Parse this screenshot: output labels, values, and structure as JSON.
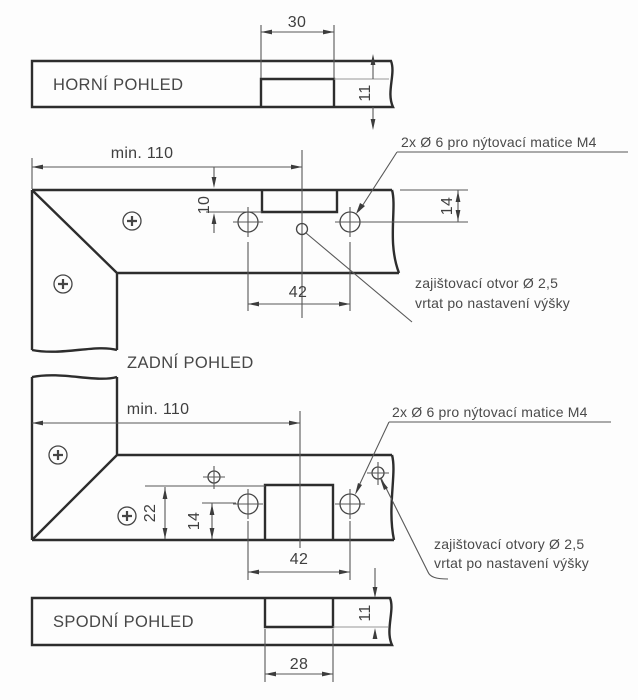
{
  "drawing_title": "Bracket mounting plate – orthographic views",
  "views": {
    "top": {
      "label": "HORNÍ POHLED",
      "dim_width": "30",
      "dim_depth": "11"
    },
    "rear": {
      "label": "ZADNÍ POHLED",
      "dim_min_width": "min. 110",
      "dim_notch_depth": "10",
      "dim_hole_offset": "14",
      "dim_hole_pitch": "42"
    },
    "front": {
      "dim_min_width": "min. 110",
      "dim_notch_depth": "22",
      "dim_hole_offset": "14",
      "dim_hole_pitch": "42"
    },
    "bottom": {
      "label": "SPODNÍ POHLED",
      "dim_width": "28",
      "dim_depth": "11"
    }
  },
  "annotations": {
    "rear_rivet_note": "2x Ø 6 pro nýtovací matice M4",
    "rear_lock_note_1": "zajištovací otvor Ø 2,5",
    "rear_lock_note_2": "vrtat po nastavení výšky",
    "front_rivet_note": "2x Ø 6 pro nýtovací matice M4",
    "front_lock_note_1": "zajištovací otvory Ø 2,5",
    "front_lock_note_2": "vrtat po nastavení výšky"
  },
  "colors": {
    "outline": "#2d2d2d",
    "thin_line": "#585858",
    "text": "#474747",
    "background": "#fdfdfd"
  }
}
